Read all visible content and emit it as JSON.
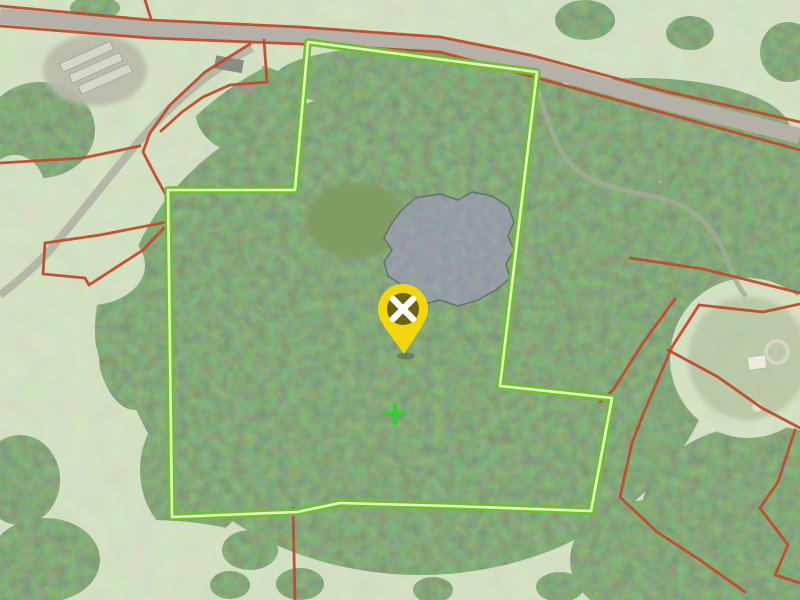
{
  "map": {
    "canvas": {
      "width": 800,
      "height": 600
    },
    "palette": {
      "field_green": "#a6bf8c",
      "woodland_green": "#3b6333",
      "pond_gray_blue": "#4b545e",
      "road_surface_gray": "#b5b1a8",
      "boundary_red": "#c14a2b",
      "parcel_outline_green": "#6fc02f",
      "parcel_core_pale": "#e8f6c6",
      "pin_yellow": "#f2d70e",
      "pin_inner_olive": "#6c6212",
      "cross_green": "#2fd32f"
    },
    "road": {
      "surface_color": "#b5b1a8",
      "width": 16,
      "path": [
        [
          0,
          16
        ],
        [
          150,
          29
        ],
        [
          300,
          35
        ],
        [
          440,
          44
        ],
        [
          530,
          65
        ],
        [
          660,
          101
        ],
        [
          800,
          136
        ]
      ]
    },
    "selected_parcel": {
      "outline_color": "#6fc02f",
      "core_color": "#e8f6c6",
      "outline_width": 7.5,
      "core_width": 2.6,
      "vertices": [
        [
          308,
          42
        ],
        [
          537,
          72
        ],
        [
          500,
          386
        ],
        [
          612,
          398
        ],
        [
          591,
          511
        ],
        [
          450,
          506
        ],
        [
          340,
          503
        ],
        [
          297,
          512
        ],
        [
          172,
          517
        ],
        [
          168,
          190
        ],
        [
          295,
          190
        ]
      ]
    },
    "other_boundaries": {
      "color": "#c14a2b",
      "width": 2.8,
      "lines": [
        [
          [
            0,
            6
          ],
          [
            150,
            20
          ],
          [
            300,
            27
          ],
          [
            440,
            37
          ],
          [
            530,
            55
          ],
          [
            660,
            90
          ],
          [
            800,
            122
          ]
        ],
        [
          [
            0,
            26
          ],
          [
            150,
            38
          ],
          [
            300,
            44
          ],
          [
            440,
            52
          ],
          [
            530,
            76
          ],
          [
            660,
            112
          ],
          [
            800,
            150
          ]
        ],
        [
          [
            145,
            0
          ],
          [
            151,
            19
          ]
        ],
        [
          [
            250,
            44
          ],
          [
            205,
            72
          ],
          [
            170,
            105
          ],
          [
            150,
            133
          ],
          [
            143,
            152
          ],
          [
            155,
            175
          ],
          [
            167,
            197
          ],
          [
            167,
            222
          ]
        ],
        [
          [
            167,
            222
          ],
          [
            100,
            235
          ],
          [
            45,
            243
          ],
          [
            43,
            274
          ],
          [
            85,
            278
          ],
          [
            89,
            285
          ],
          [
            143,
            250
          ],
          [
            164,
            228
          ]
        ],
        [
          [
            264,
            40
          ],
          [
            267,
            82
          ],
          [
            230,
            85
          ],
          [
            203,
            97
          ],
          [
            182,
            112
          ],
          [
            161,
            131
          ]
        ],
        [
          [
            0,
            163
          ],
          [
            83,
            158
          ],
          [
            140,
            146
          ]
        ],
        [
          [
            293,
            508
          ],
          [
            295,
            600
          ]
        ],
        [
          [
            630,
            258
          ],
          [
            703,
            269
          ],
          [
            800,
            293
          ]
        ],
        [
          [
            699,
            305
          ],
          [
            763,
            312
          ],
          [
            800,
            304
          ]
        ],
        [
          [
            699,
            305
          ],
          [
            672,
            347
          ],
          [
            645,
            410
          ],
          [
            632,
            443
          ],
          [
            620,
            497
          ],
          [
            657,
            532
          ],
          [
            700,
            560
          ],
          [
            745,
            592
          ]
        ],
        [
          [
            675,
            299
          ],
          [
            643,
            343
          ],
          [
            613,
            390
          ],
          [
            600,
            402
          ]
        ],
        [
          [
            668,
            350
          ],
          [
            718,
            377
          ],
          [
            762,
            408
          ],
          [
            800,
            428
          ]
        ],
        [
          [
            795,
            430
          ],
          [
            778,
            482
          ],
          [
            760,
            508
          ],
          [
            788,
            545
          ],
          [
            775,
            575
          ],
          [
            800,
            583
          ]
        ]
      ]
    },
    "pond": {
      "fill": "#4b545e",
      "rim_color": "#39434c",
      "outline": [
        [
          400,
          212
        ],
        [
          415,
          198
        ],
        [
          440,
          194
        ],
        [
          458,
          200
        ],
        [
          472,
          192
        ],
        [
          492,
          196
        ],
        [
          508,
          206
        ],
        [
          514,
          222
        ],
        [
          508,
          236
        ],
        [
          514,
          250
        ],
        [
          506,
          264
        ],
        [
          510,
          278
        ],
        [
          496,
          290
        ],
        [
          478,
          300
        ],
        [
          458,
          306
        ],
        [
          440,
          300
        ],
        [
          424,
          304
        ],
        [
          410,
          296
        ],
        [
          400,
          284
        ],
        [
          388,
          276
        ],
        [
          384,
          262
        ],
        [
          392,
          250
        ],
        [
          384,
          238
        ],
        [
          390,
          226
        ]
      ]
    },
    "markers": {
      "location_pin": {
        "tip": [
          404,
          354
        ],
        "head_center": [
          403,
          309
        ],
        "head_radius": 25,
        "inner_radius": 16,
        "head_color": "#f2d70e",
        "inner_color": "#6c6212",
        "glyph": "x",
        "glyph_color": "#ffffff"
      },
      "crosshair": {
        "center": [
          395,
          414
        ],
        "arm": 11,
        "stroke_width": 4,
        "color": "#2fd32f"
      }
    }
  }
}
